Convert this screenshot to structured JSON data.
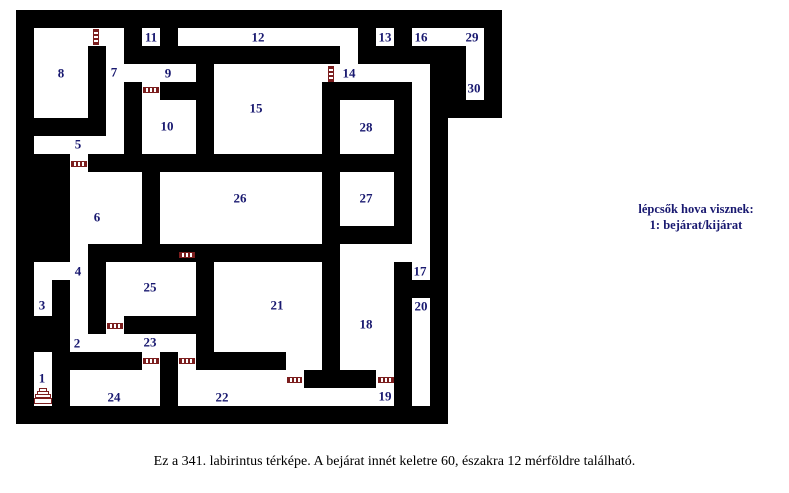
{
  "page": {
    "background": "#ffffff"
  },
  "legend": {
    "line1": "lépcsők hova visznek:",
    "line2": "1: bejárat/kijárat"
  },
  "caption": "Ez a 341. labirintus térképe. A bejárat innét keletre 60, északra 12 mérföldre található.",
  "maze": {
    "wall_color": "#000000",
    "room_color": "#ffffff",
    "label_color": "#191970",
    "door_color": "#7b1e1e",
    "black_blocks": [
      {
        "name": "maze-body",
        "rect": [
          16,
          10,
          432,
          414
        ]
      },
      {
        "name": "maze-top-right-block",
        "rect": [
          448,
          10,
          54,
          108
        ]
      }
    ],
    "white_cells": [
      {
        "name": "room-8",
        "rect": [
          34,
          28,
          54,
          90
        ]
      },
      {
        "name": "doorway-8-7",
        "rect": [
          88,
          28,
          18,
          18
        ]
      },
      {
        "name": "corridor-7",
        "rect": [
          106,
          28,
          18,
          126
        ]
      },
      {
        "name": "room-5-strip",
        "rect": [
          34,
          136,
          72,
          18
        ]
      },
      {
        "name": "doorway-5-6",
        "rect": [
          70,
          154,
          18,
          18
        ]
      },
      {
        "name": "room-6",
        "rect": [
          70,
          172,
          72,
          72
        ]
      },
      {
        "name": "room-11",
        "rect": [
          142,
          28,
          18,
          18
        ]
      },
      {
        "name": "corridor-12",
        "rect": [
          178,
          28,
          180,
          18
        ]
      },
      {
        "name": "corridor-12-turn",
        "rect": [
          340,
          46,
          18,
          18
        ]
      },
      {
        "name": "corridor-9",
        "rect": [
          106,
          64,
          90,
          18
        ]
      },
      {
        "name": "doorway-9-10",
        "rect": [
          142,
          82,
          18,
          18
        ]
      },
      {
        "name": "room-10",
        "rect": [
          142,
          100,
          54,
          54
        ]
      },
      {
        "name": "room-15",
        "rect": [
          214,
          64,
          108,
          90
        ]
      },
      {
        "name": "corridor-14",
        "rect": [
          322,
          64,
          108,
          18
        ]
      },
      {
        "name": "corridor-17",
        "rect": [
          412,
          82,
          18,
          198
        ]
      },
      {
        "name": "room-13",
        "rect": [
          376,
          28,
          18,
          18
        ]
      },
      {
        "name": "room-16",
        "rect": [
          412,
          28,
          72,
          18
        ]
      },
      {
        "name": "corridor-29-30",
        "rect": [
          466,
          28,
          18,
          72
        ]
      },
      {
        "name": "room-28",
        "rect": [
          340,
          100,
          54,
          54
        ]
      },
      {
        "name": "room-26",
        "rect": [
          160,
          172,
          162,
          72
        ]
      },
      {
        "name": "room-27",
        "rect": [
          340,
          172,
          54,
          54
        ]
      },
      {
        "name": "corridor-27-18",
        "rect": [
          340,
          244,
          90,
          18
        ]
      },
      {
        "name": "room-18",
        "rect": [
          340,
          262,
          54,
          108
        ]
      },
      {
        "name": "room-3",
        "rect": [
          34,
          262,
          18,
          54
        ]
      },
      {
        "name": "room-4",
        "rect": [
          52,
          262,
          36,
          18
        ]
      },
      {
        "name": "corridor-4-2",
        "rect": [
          70,
          244,
          18,
          108
        ]
      },
      {
        "name": "room-25",
        "rect": [
          106,
          262,
          90,
          54
        ]
      },
      {
        "name": "doorway-25-23",
        "rect": [
          106,
          316,
          18,
          18
        ]
      },
      {
        "name": "room-21",
        "rect": [
          214,
          262,
          108,
          90
        ]
      },
      {
        "name": "corridor-23",
        "rect": [
          70,
          334,
          126,
          18
        ]
      },
      {
        "name": "doorway-23-24",
        "rect": [
          142,
          352,
          18,
          18
        ]
      },
      {
        "name": "doorway-23-22",
        "rect": [
          178,
          352,
          18,
          18
        ]
      },
      {
        "name": "room-24",
        "rect": [
          70,
          370,
          90,
          36
        ]
      },
      {
        "name": "room-22",
        "rect": [
          178,
          370,
          108,
          36
        ]
      },
      {
        "name": "doorway-21-19a",
        "rect": [
          286,
          352,
          36,
          18
        ]
      },
      {
        "name": "doorway-21-19b",
        "rect": [
          286,
          370,
          18,
          18
        ]
      },
      {
        "name": "doorway-18-19",
        "rect": [
          376,
          370,
          18,
          18
        ]
      },
      {
        "name": "corridor-19",
        "rect": [
          286,
          388,
          108,
          18
        ]
      },
      {
        "name": "room-20",
        "rect": [
          412,
          298,
          18,
          108
        ]
      },
      {
        "name": "room-1",
        "rect": [
          34,
          352,
          18,
          54
        ]
      }
    ],
    "doors": [
      {
        "dir": "v",
        "rect": [
          93,
          29,
          6,
          16
        ]
      },
      {
        "dir": "v",
        "rect": [
          328,
          66,
          6,
          16
        ]
      },
      {
        "dir": "h",
        "rect": [
          143,
          87,
          16,
          6
        ]
      },
      {
        "dir": "h",
        "rect": [
          71,
          161,
          16,
          6
        ]
      },
      {
        "dir": "h",
        "rect": [
          179,
          252,
          16,
          6
        ]
      },
      {
        "dir": "h",
        "rect": [
          107,
          323,
          16,
          6
        ]
      },
      {
        "dir": "h",
        "rect": [
          143,
          358,
          16,
          6
        ]
      },
      {
        "dir": "h",
        "rect": [
          179,
          358,
          16,
          6
        ]
      },
      {
        "dir": "h",
        "rect": [
          287,
          377,
          15,
          6
        ]
      },
      {
        "dir": "h",
        "rect": [
          378,
          377,
          16,
          6
        ]
      }
    ],
    "stairs": {
      "x": 34,
      "y": 388,
      "w": 18,
      "h": 18,
      "steps": [
        {
          "rect": [
            5,
            0,
            8,
            4
          ]
        },
        {
          "rect": [
            3,
            3,
            12,
            4
          ]
        },
        {
          "rect": [
            1,
            6,
            16,
            4
          ]
        },
        {
          "rect": [
            0,
            10,
            18,
            6
          ]
        }
      ]
    },
    "labels": [
      {
        "n": "1",
        "x": 42,
        "y": 378
      },
      {
        "n": "2",
        "x": 77,
        "y": 343
      },
      {
        "n": "3",
        "x": 42,
        "y": 305
      },
      {
        "n": "4",
        "x": 78,
        "y": 271
      },
      {
        "n": "5",
        "x": 78,
        "y": 144
      },
      {
        "n": "6",
        "x": 97,
        "y": 217
      },
      {
        "n": "7",
        "x": 114,
        "y": 72
      },
      {
        "n": "8",
        "x": 61,
        "y": 73
      },
      {
        "n": "9",
        "x": 168,
        "y": 73
      },
      {
        "n": "10",
        "x": 167,
        "y": 126
      },
      {
        "n": "11",
        "x": 151,
        "y": 37
      },
      {
        "n": "12",
        "x": 258,
        "y": 37
      },
      {
        "n": "13",
        "x": 385,
        "y": 37
      },
      {
        "n": "14",
        "x": 349,
        "y": 73
      },
      {
        "n": "15",
        "x": 256,
        "y": 108
      },
      {
        "n": "16",
        "x": 421,
        "y": 37
      },
      {
        "n": "17",
        "x": 420,
        "y": 271
      },
      {
        "n": "18",
        "x": 366,
        "y": 324
      },
      {
        "n": "19",
        "x": 385,
        "y": 396
      },
      {
        "n": "20",
        "x": 421,
        "y": 306
      },
      {
        "n": "21",
        "x": 277,
        "y": 305
      },
      {
        "n": "22",
        "x": 222,
        "y": 397
      },
      {
        "n": "23",
        "x": 150,
        "y": 342
      },
      {
        "n": "24",
        "x": 114,
        "y": 397
      },
      {
        "n": "25",
        "x": 150,
        "y": 287
      },
      {
        "n": "26",
        "x": 240,
        "y": 198
      },
      {
        "n": "27",
        "x": 366,
        "y": 198
      },
      {
        "n": "28",
        "x": 366,
        "y": 127
      },
      {
        "n": "29",
        "x": 472,
        "y": 37
      },
      {
        "n": "30",
        "x": 474,
        "y": 88
      }
    ]
  }
}
